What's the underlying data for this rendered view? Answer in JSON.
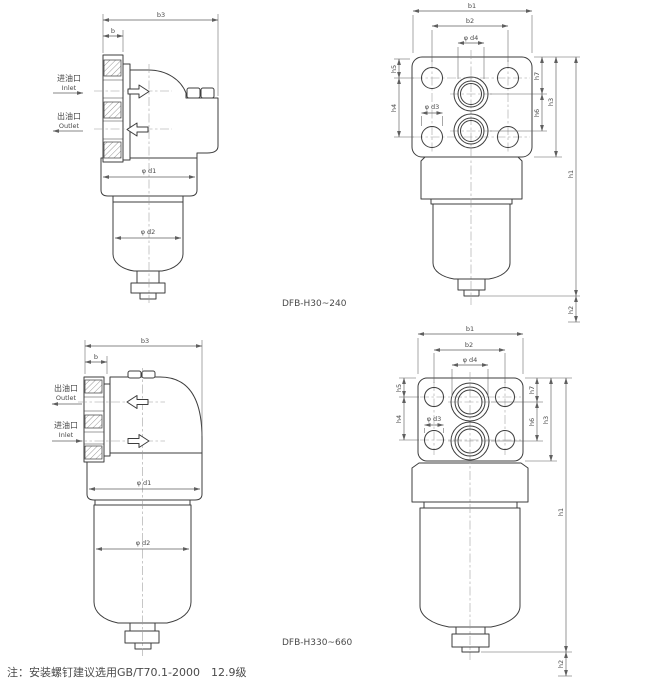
{
  "colors": {
    "background": "#ffffff",
    "object_line": "#3d3d3d",
    "dim_line": "#5f5f5f",
    "centerline": "#9a9a9a",
    "text": "#4a4a4a"
  },
  "dim_labels": {
    "b": "b",
    "b1": "b1",
    "b2": "b2",
    "b3": "b3",
    "h1": "h1",
    "h2": "h2",
    "h3": "h3",
    "h4": "h4",
    "h5": "h5",
    "h6": "h6",
    "h7": "h7",
    "d1": "φ d1",
    "d2": "φ d2",
    "d3": "φ d3",
    "d4": "φ d4"
  },
  "port_labels": {
    "inlet_cn": "进油口",
    "inlet_en": "Inlet",
    "outlet_cn": "出油口",
    "outlet_en": "Outlet"
  },
  "captions": {
    "series_small": "DFB-H30~240",
    "series_large": "DFB-H330~660"
  },
  "footnote": "注：安装螺钉建议选用GB/T70.1-2000　12.9级"
}
